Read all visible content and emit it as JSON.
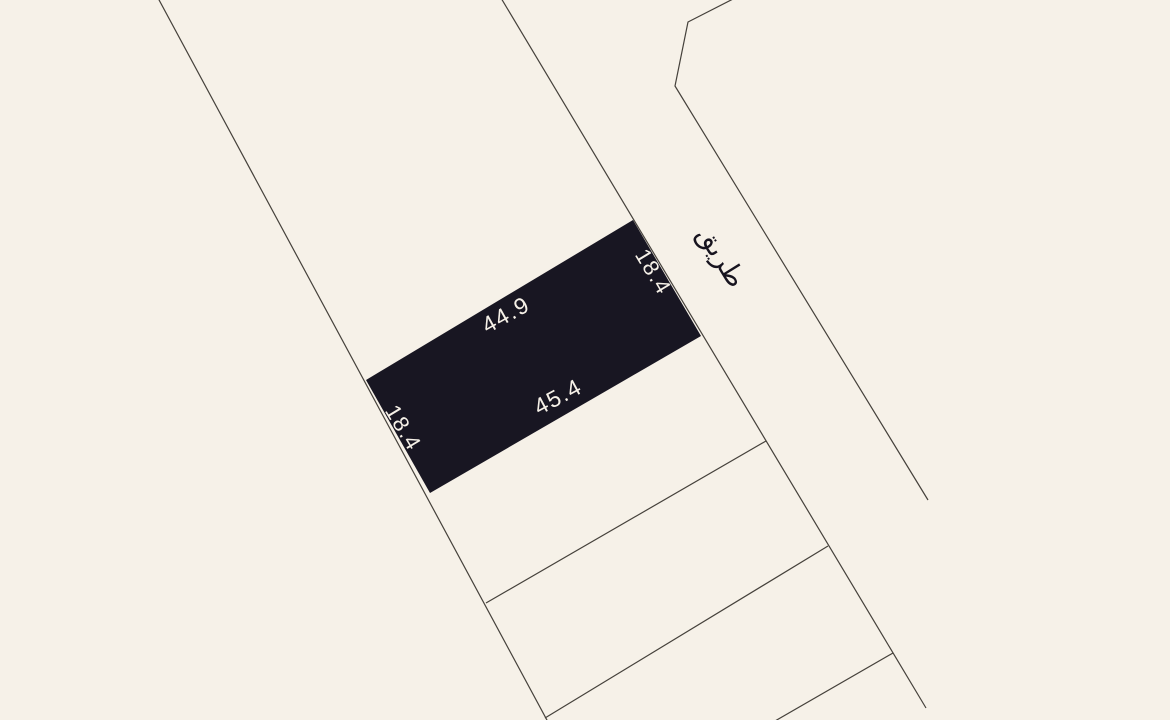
{
  "canvas": {
    "width": 1170,
    "height": 720,
    "background": "#f6f1e8"
  },
  "road": {
    "label": "طريق"
  },
  "selected_plot": {
    "fill": "#181622",
    "dimensions": {
      "top_edge": "44.9",
      "bottom_edge": "45.4",
      "left_edge": "18.4",
      "right_edge": "18.4"
    }
  },
  "labels": [
    {
      "name": "dimension-label-top-edge",
      "text": "44.9",
      "x": 506,
      "y": 315,
      "rot": -29,
      "size": 23,
      "color": "#f6f1e8"
    },
    {
      "name": "dimension-label-bottom-edge",
      "text": "45.4",
      "x": 558,
      "y": 397,
      "rot": -28,
      "size": 23,
      "color": "#f6f1e8"
    },
    {
      "name": "dimension-label-right-edge",
      "text": "18.4",
      "x": 653,
      "y": 272,
      "rot": 59,
      "size": 22,
      "color": "#f6f1e8"
    },
    {
      "name": "dimension-label-left-edge",
      "text": "18.4",
      "x": 403,
      "y": 428,
      "rot": 59,
      "size": 22,
      "color": "#f6f1e8"
    },
    {
      "name": "road-name-label",
      "text": "طريق",
      "x": 721,
      "y": 257,
      "rot": 58,
      "size": 27,
      "color": "#17141f"
    }
  ],
  "geometry": {
    "stroke": "#45413b",
    "stroke_width": 1.2,
    "parcel_lines": [
      {
        "name": "west-boundary-line",
        "points": [
          [
            158,
            -2
          ],
          [
            548,
            722
          ]
        ]
      },
      {
        "name": "east-boundary-line",
        "points": [
          [
            501,
            -2
          ],
          [
            926,
            708
          ]
        ]
      },
      {
        "name": "road-east-line",
        "points": [
          [
            735,
            -2
          ],
          [
            688,
            22
          ],
          [
            675,
            86
          ],
          [
            928,
            500
          ]
        ]
      },
      {
        "name": "parcel-divider-line-a",
        "points": [
          [
            486,
            603
          ],
          [
            766,
            441
          ]
        ]
      },
      {
        "name": "parcel-divider-line-b",
        "points": [
          [
            545,
            718
          ],
          [
            828,
            546
          ]
        ]
      },
      {
        "name": "parcel-divider-line-c",
        "points": [
          [
            775,
            721
          ],
          [
            893,
            653
          ]
        ]
      }
    ],
    "selected_plot_points": [
      [
        366,
        380
      ],
      [
        633,
        220
      ],
      [
        701,
        336
      ],
      [
        430,
        493
      ]
    ]
  }
}
